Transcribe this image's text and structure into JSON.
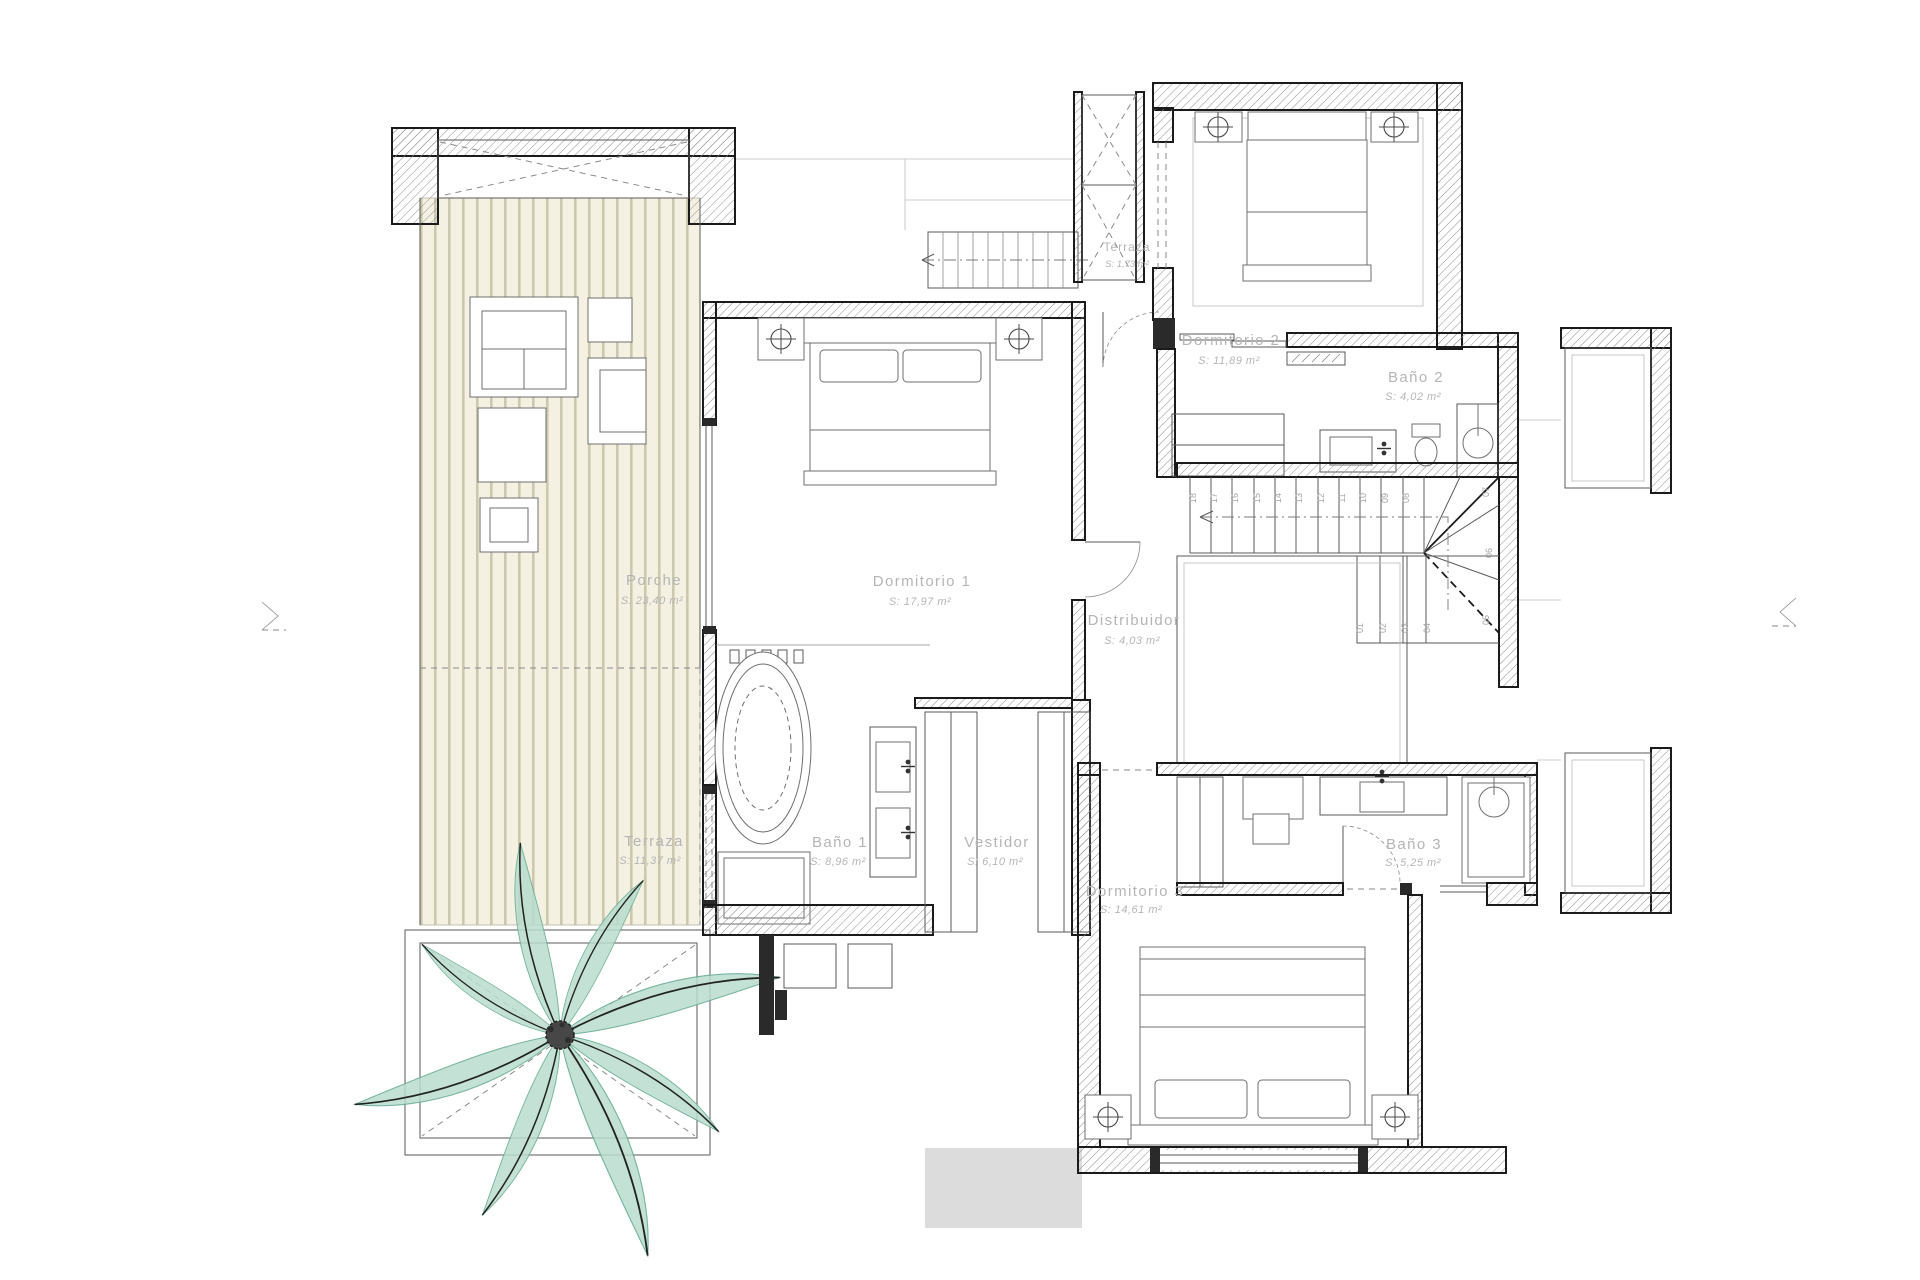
{
  "drawing": {
    "kind": "first-floor plan"
  },
  "colors": {
    "label": "#b5b5b5",
    "deck_bg": "#f4f1e2",
    "deck_line": "#ccc8ae",
    "palm_leaf": "#b9dccd",
    "palm_edge": "#5fa98e",
    "wall": "#1b1b1b"
  },
  "rooms": [
    {
      "name": "Porche",
      "area": "S: 23,40 m²"
    },
    {
      "name": "Terraza",
      "area": "S: 11,37 m²"
    },
    {
      "name": "Dormitorio 1",
      "area": "S: 17,97 m²"
    },
    {
      "name": "Baño 1",
      "area": "S: 8,96 m²"
    },
    {
      "name": "Vestidor",
      "area": "S: 6,10 m²"
    },
    {
      "name": "Distribuidor",
      "area": "S: 4,03 m²"
    },
    {
      "name": "Terraza",
      "area": "S: 1,73 m²"
    },
    {
      "name": "Dormitorio 2",
      "area": "S: 11,89 m²"
    },
    {
      "name": "Baño 2",
      "area": "S: 4,02 m²"
    },
    {
      "name": "Dormitorio 3",
      "area": "S: 14,61 m²"
    },
    {
      "name": "Baño 3",
      "area": "S: 5,25 m²"
    }
  ],
  "stairs": {
    "steps": [
      "01",
      "02",
      "03",
      "04",
      "05",
      "06",
      "07",
      "08",
      "09",
      "10",
      "11",
      "12",
      "13",
      "14",
      "15",
      "16",
      "17",
      "18"
    ]
  }
}
